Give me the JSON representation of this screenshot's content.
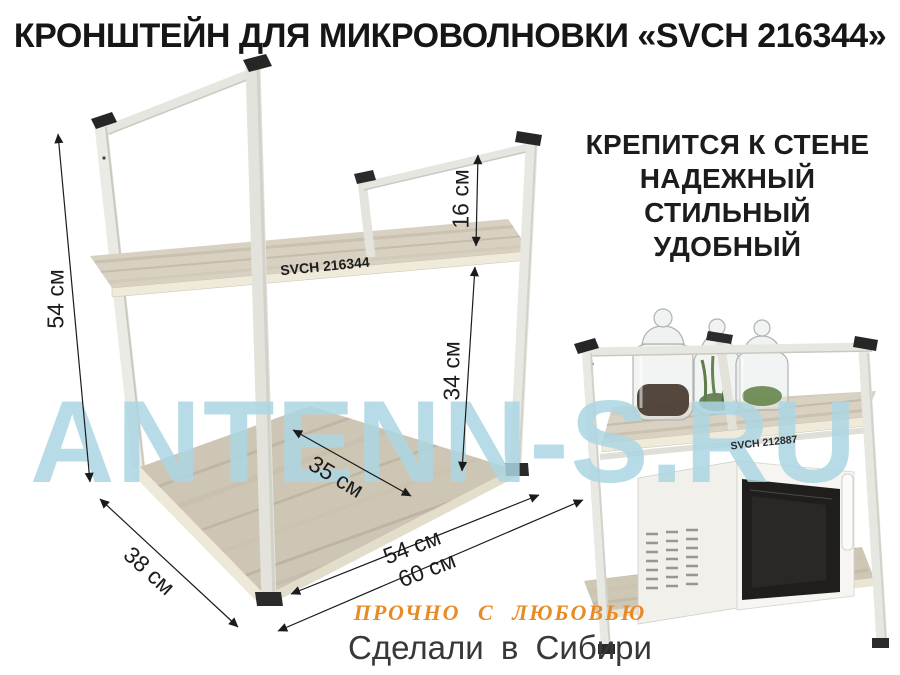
{
  "title": "КРОНШТЕЙН ДЛЯ МИКРОВОЛНОВКИ «SVCH 216344»",
  "features": {
    "items": [
      "КРЕПИТСЯ К СТЕНЕ",
      "НАДЕЖНЫЙ",
      "СТИЛЬНЫЙ",
      "УДОБНЫЙ"
    ]
  },
  "watermark": {
    "text": "ANTENN-S.RU",
    "color": "#ADD8E4"
  },
  "diagram": {
    "product_label": "SVCH 216344",
    "dimensions": {
      "height": "54 см",
      "rail_height": "16 см",
      "shelf_to_base": "34 см",
      "base_depth_inner": "35 см",
      "depth": "38 см",
      "width_inner": "54 см",
      "width_outer": "60 см"
    }
  },
  "photo": {
    "shelf_label": "SVCH 212887"
  },
  "footer": {
    "slogan": "ПРОЧНО С ЛЮБОВЬЮ",
    "made_in": "Сделали в Сибири"
  },
  "colors": {
    "frame": "#E9E9E3",
    "frame_shadow": "#C6C6BE",
    "wood": "#D5CEC0",
    "wood_dark": "#B4A997",
    "accent_orange": "#E78B27",
    "text": "#1A1A1A"
  }
}
